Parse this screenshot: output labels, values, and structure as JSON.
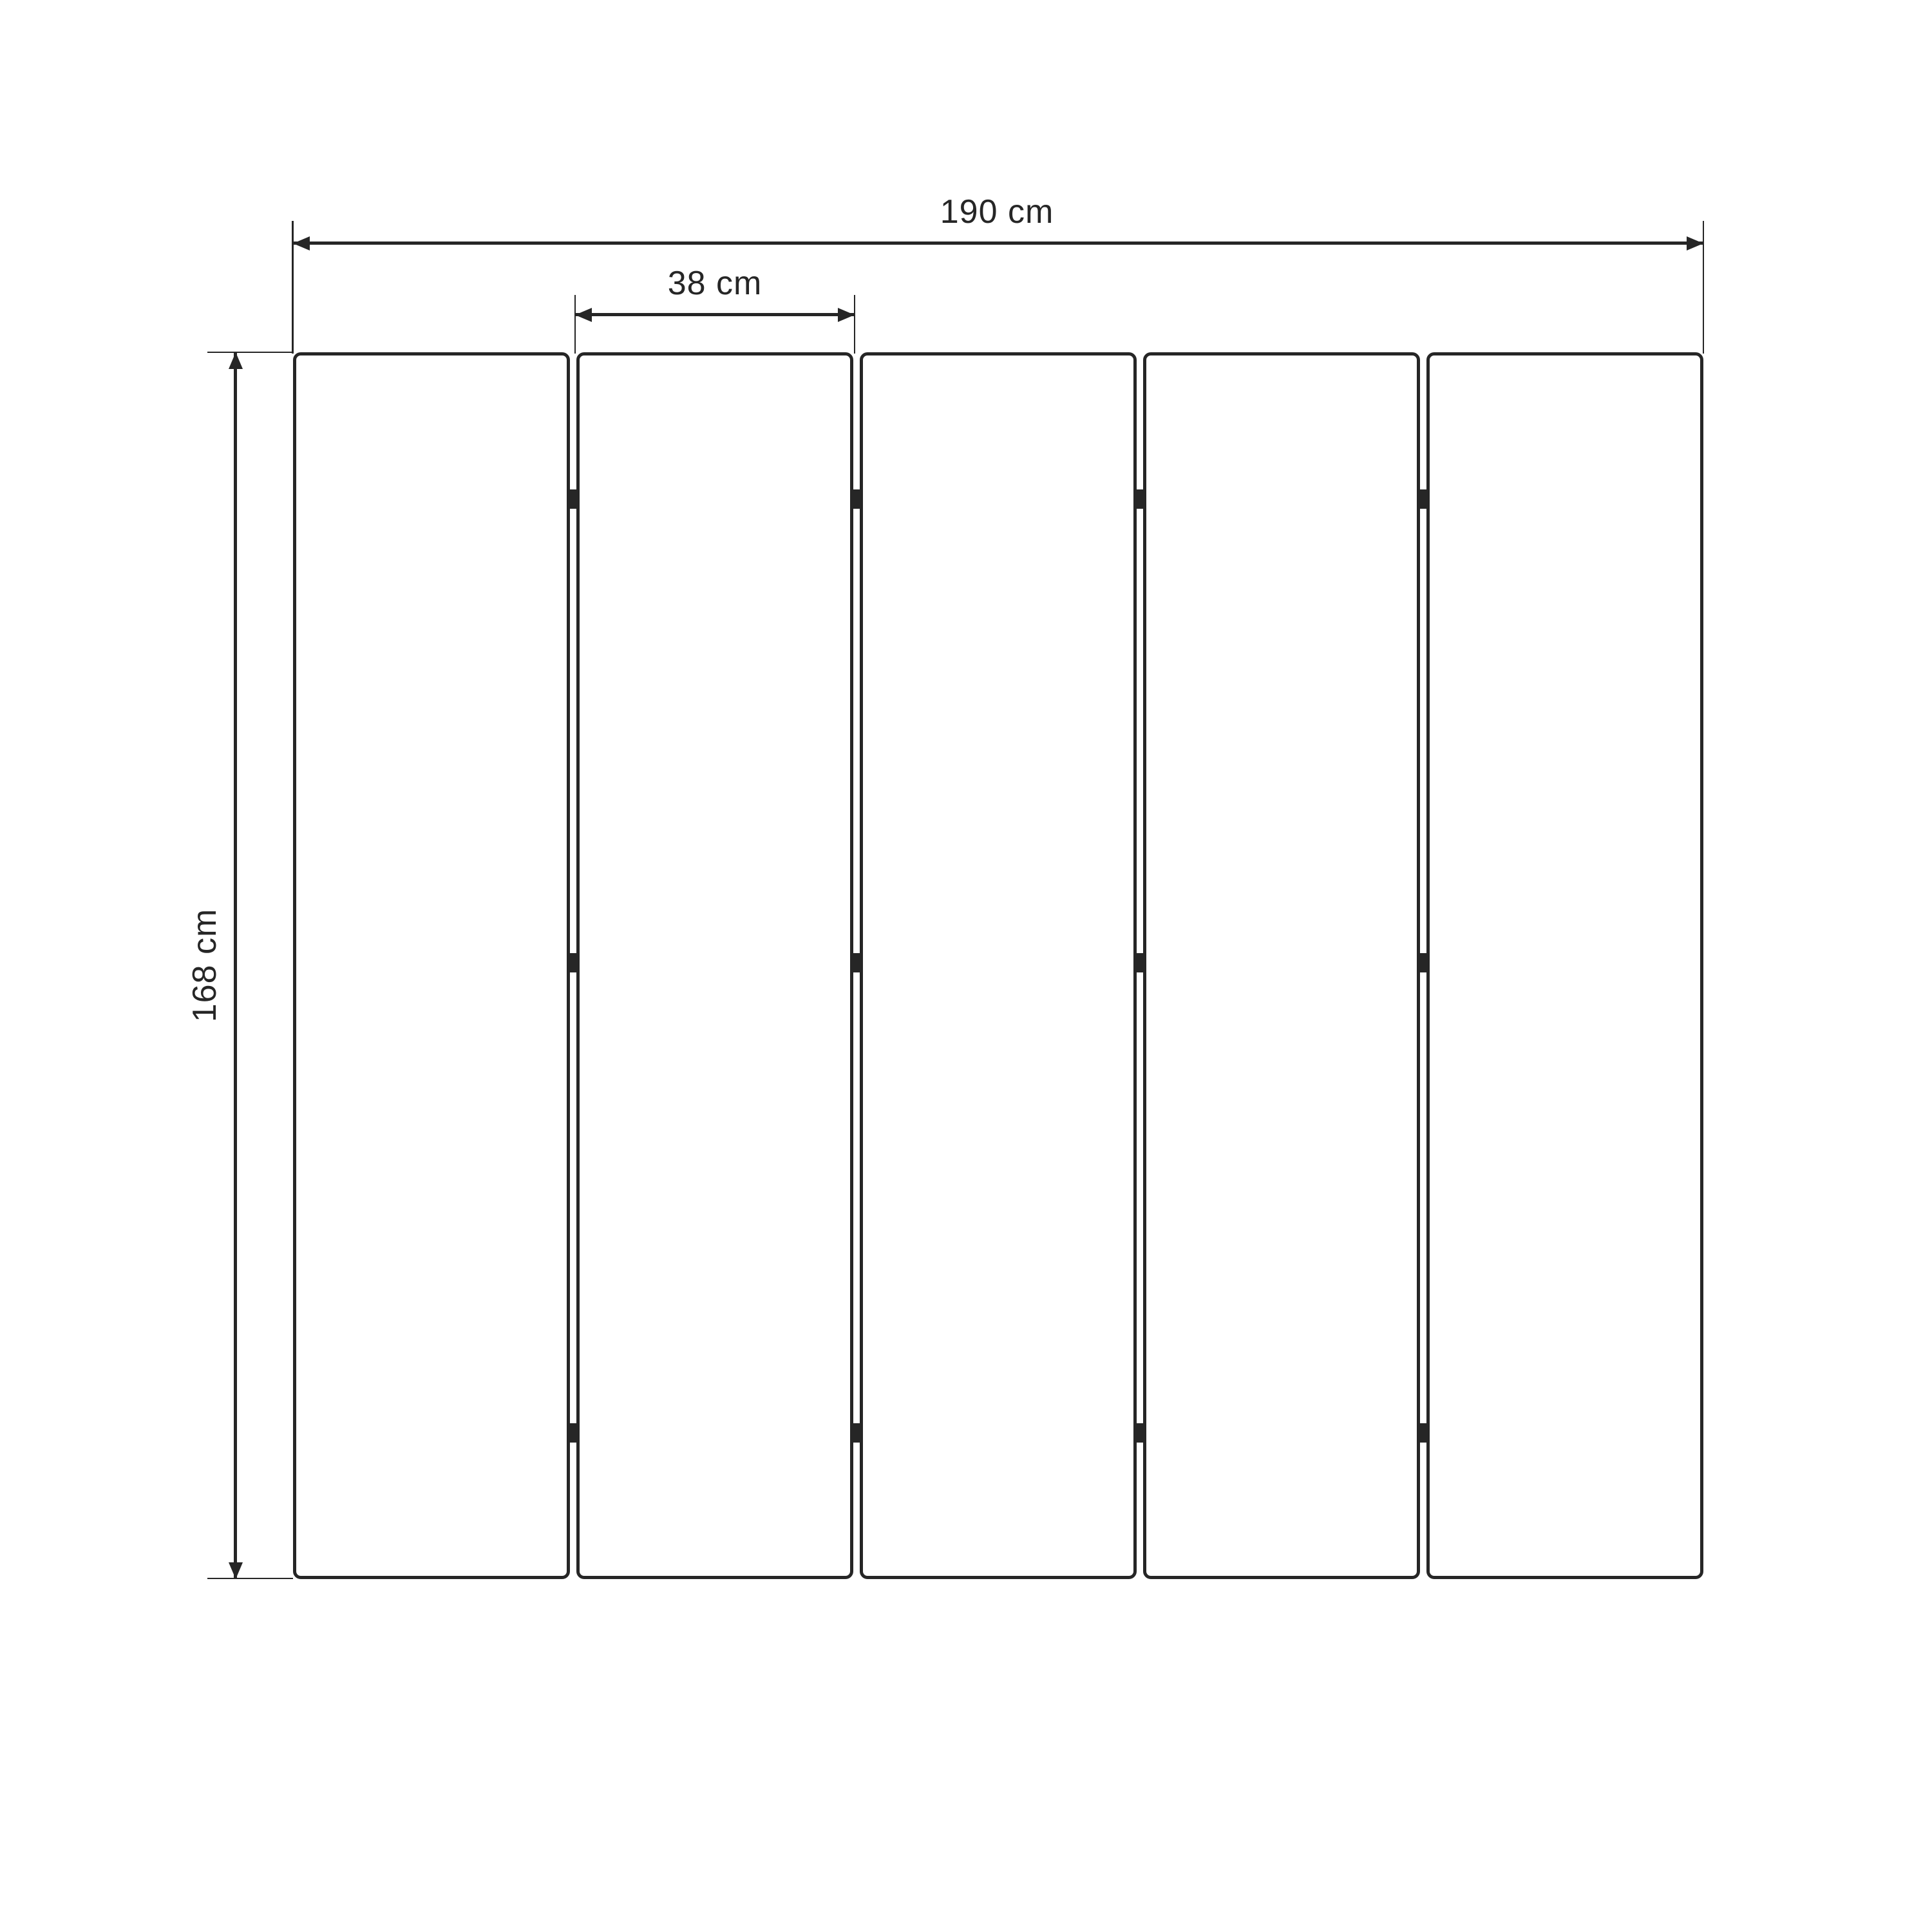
{
  "diagram": {
    "type": "technical-dimension-drawing",
    "subject": "five-panel folding screen front view",
    "background_color": "#ffffff",
    "line_color": "#262626",
    "panels": {
      "count": 5,
      "hinge_rows_per_gap": 3,
      "gap_count": 4
    },
    "dimensions": {
      "total_width": {
        "label": "190 cm",
        "value": 190,
        "unit": "cm",
        "orientation": "horizontal"
      },
      "panel_width": {
        "label": "38 cm",
        "value": 38,
        "unit": "cm",
        "orientation": "horizontal"
      },
      "height": {
        "label": "168 cm",
        "value": 168,
        "unit": "cm",
        "orientation": "vertical"
      }
    }
  }
}
